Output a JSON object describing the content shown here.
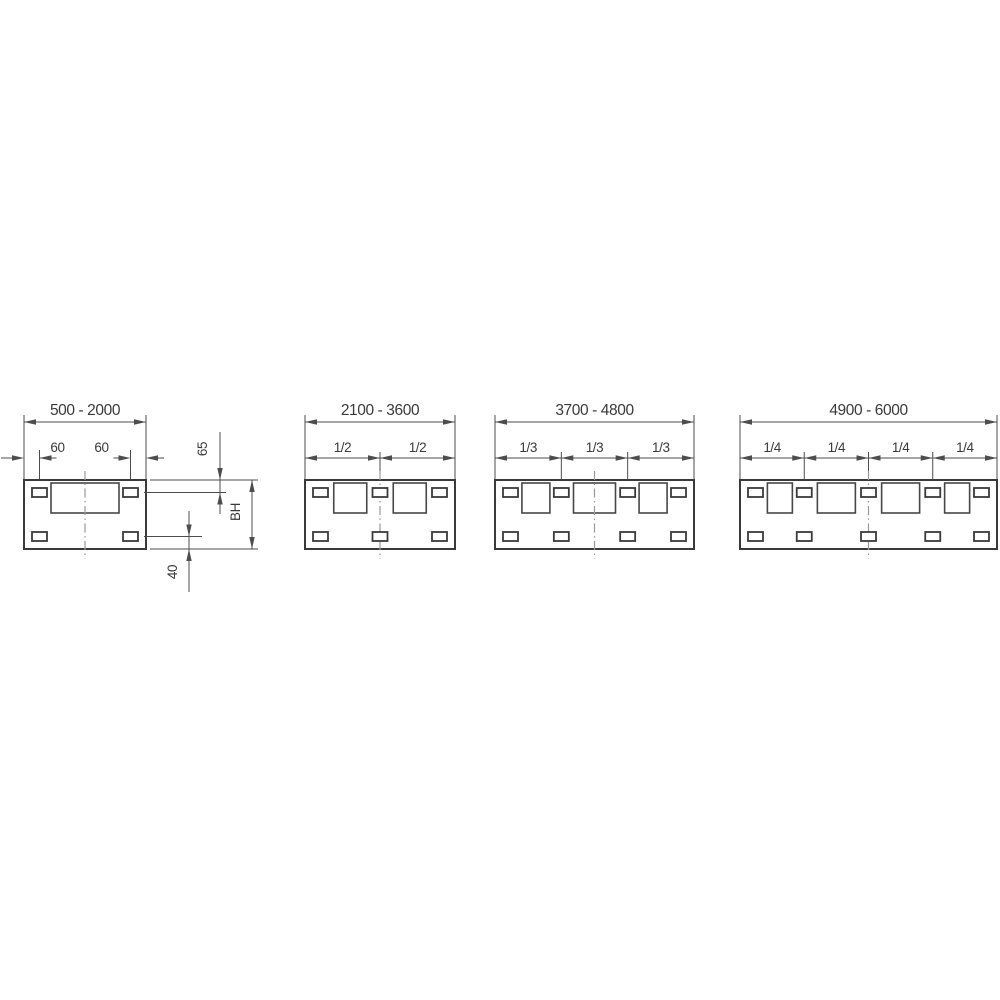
{
  "canvas": {
    "width": 1000,
    "height": 1000,
    "background": "#ffffff"
  },
  "style": {
    "shape_color": "#3a3a3a",
    "dim_color": "#4d4d4d",
    "text_color": "#3a3a3a",
    "centerline_color": "#9a9a9a"
  },
  "panels": [
    {
      "id": "panel-500-2000",
      "range_label": "500 - 2000",
      "segments": 1,
      "segment_labels": [],
      "x": 24,
      "width": 122,
      "opening_widths": [
        68
      ],
      "edge_dims": [
        {
          "label": "60",
          "side": "left"
        },
        {
          "label": "60",
          "side": "right"
        }
      ]
    },
    {
      "id": "panel-2100-3600",
      "range_label": "2100 - 3600",
      "segments": 2,
      "segment_labels": [
        "1/2",
        "1/2"
      ],
      "x": 305,
      "width": 150,
      "opening_widths": [
        33,
        33
      ]
    },
    {
      "id": "panel-3700-4800",
      "range_label": "3700 - 4800",
      "segments": 3,
      "segment_labels": [
        "1/3",
        "1/3",
        "1/3"
      ],
      "x": 495,
      "width": 199,
      "opening_widths": [
        28,
        42,
        28
      ]
    },
    {
      "id": "panel-4900-6000",
      "range_label": "4900 - 6000",
      "segments": 4,
      "segment_labels": [
        "1/4",
        "1/4",
        "1/4",
        "1/4"
      ],
      "x": 740,
      "width": 257,
      "opening_widths": [
        25,
        38,
        38,
        25
      ]
    }
  ],
  "side_dimensions": {
    "top_edge_to_slot": "65",
    "panel_height": "BH",
    "slot_to_bottom_edge": "40"
  }
}
